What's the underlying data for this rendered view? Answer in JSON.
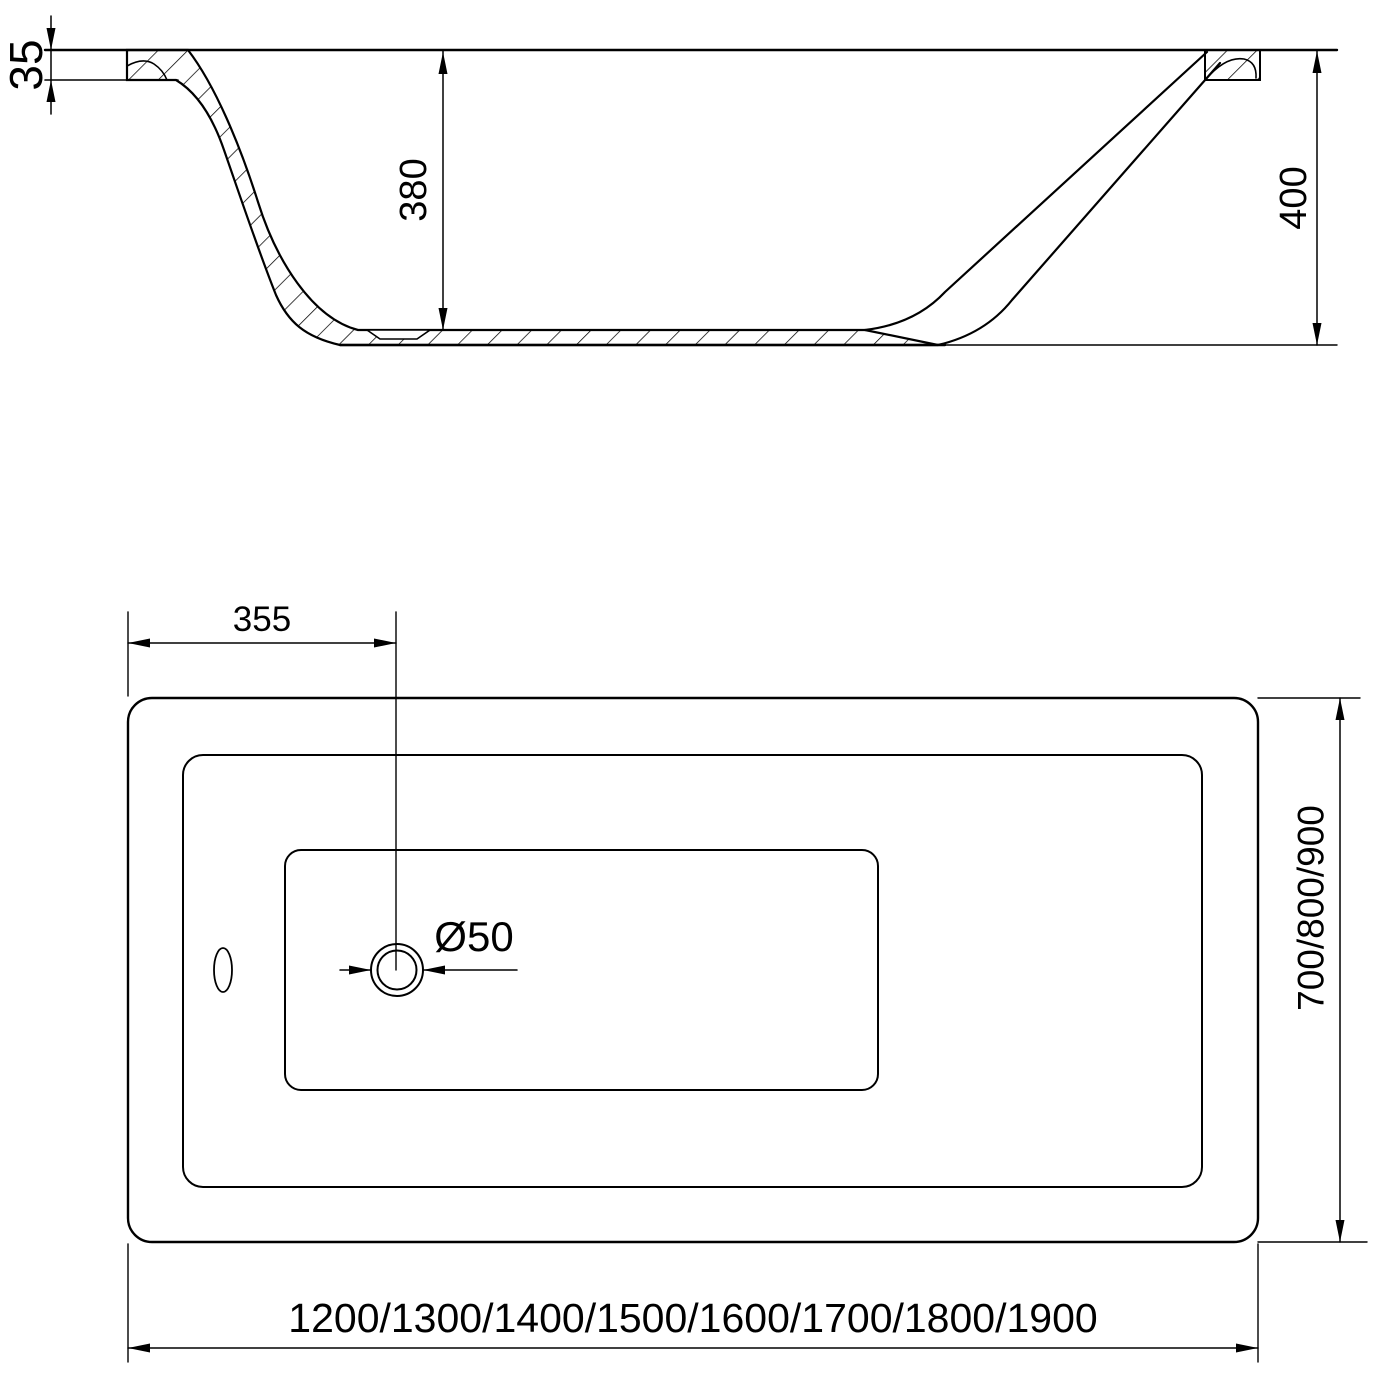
{
  "drawing": {
    "section_view": {
      "rim_thickness": "35",
      "inner_depth": "380",
      "overall_height": "400"
    },
    "plan_view": {
      "drain_offset": "355",
      "drain_diameter": "Ø50",
      "width_options": "700/800/900",
      "length_options": "1200/1300/1400/1500/1600/1700/1800/1900"
    }
  }
}
